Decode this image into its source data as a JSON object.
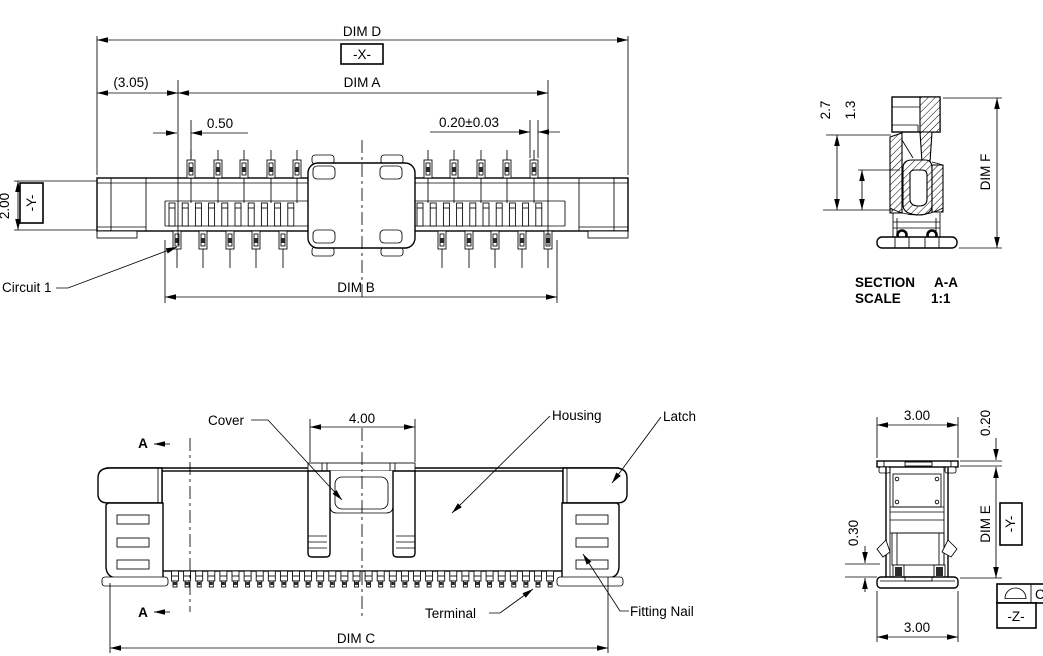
{
  "page": {
    "background": "#ffffff",
    "line_color": "#000000"
  },
  "top_view": {
    "dim_d": "DIM D",
    "datum_x": "-X-",
    "dim_overall_ref": "(3.05)",
    "dim_a": "DIM A",
    "pitch": "0.50",
    "pin_width": "0.20±0.03",
    "height": "2.00",
    "datum_y": "-Y-",
    "circuit_label": "Circuit 1",
    "dim_b": "DIM B"
  },
  "section_view": {
    "dim_27": "2.7",
    "dim_13": "1.3",
    "dim_f": "DIM F",
    "title_label": "SECTION",
    "title_name": "A-A",
    "scale_label": "SCALE",
    "scale_value": "1:1"
  },
  "front_view": {
    "cover_label": "Cover",
    "cover_width": "4.00",
    "housing_label": "Housing",
    "latch_label": "Latch",
    "section_marker": "A",
    "terminal_label": "Terminal",
    "fitting_nail_label": "Fitting Nail",
    "dim_c": "DIM C"
  },
  "side_view": {
    "width_top": "3.00",
    "dim_020": "0.20",
    "dim_030": "0.30",
    "dim_e": "DIM E",
    "datum_y": "-Y-",
    "datum_z": "-Z-",
    "width_bottom": "3.00",
    "datum_target": "C"
  }
}
